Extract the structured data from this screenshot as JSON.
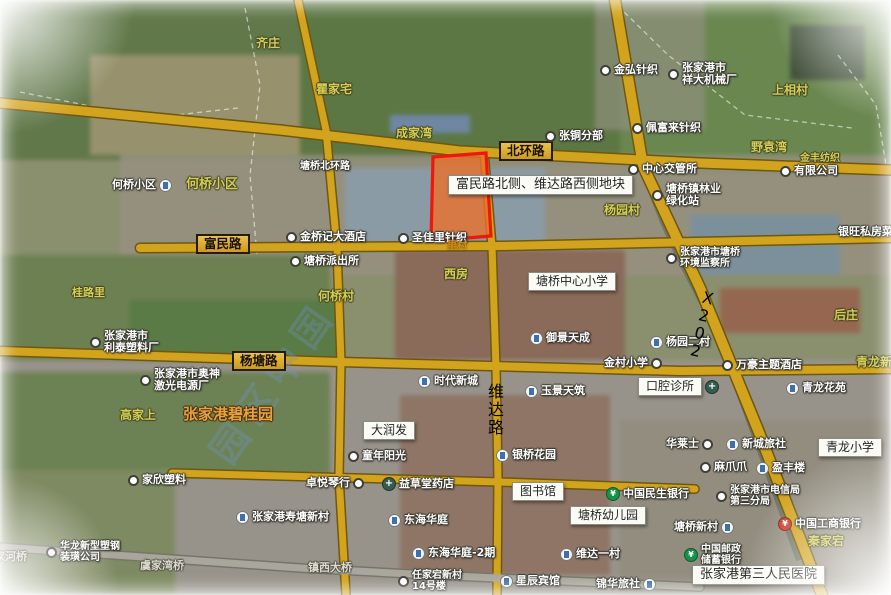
{
  "map": {
    "watermark": "园区中国",
    "colors": {
      "road_gold": "#d2a31c",
      "road_casing": "#6e570f",
      "parcel_border": "#ee1708",
      "parcel_fill": "#e8702d",
      "label_gold_box": "#ddab2b"
    },
    "parcel": {
      "label": "富民路北侧、维达路西侧地块"
    },
    "labels": [
      {
        "t": "齐庄",
        "type": "village",
        "x": 256,
        "y": 37,
        "name": "village-label-qizhuang"
      },
      {
        "t": "瞿家宅",
        "type": "village",
        "x": 316,
        "y": 83,
        "name": "village-label-qujiazhai"
      },
      {
        "t": "成家湾",
        "type": "village",
        "x": 396,
        "y": 127,
        "name": "village-label-chengjiawan"
      },
      {
        "t": "北环路",
        "type": "roadbox",
        "x": 499,
        "y": 141,
        "name": "road-label-beihuanlu"
      },
      {
        "t": "张铜分部",
        "type": "poi",
        "icon": "dot",
        "x": 545,
        "y": 130,
        "name": "poi-zhangtong-branch"
      },
      {
        "t": "金弘针织",
        "type": "poi",
        "icon": "dot",
        "x": 600,
        "y": 64,
        "name": "poi-jinhong-knitting"
      },
      {
        "t": "张家港市",
        "t2": "祥大机械厂",
        "type": "poi",
        "icon": "dot",
        "x": 668,
        "y": 62,
        "name": "poi-xiangda-machinery"
      },
      {
        "t": "上相村",
        "type": "village",
        "x": 772,
        "y": 84,
        "name": "village-label-shangxiang"
      },
      {
        "t": "佩富来针织",
        "type": "poi",
        "icon": "dot",
        "x": 632,
        "y": 122,
        "name": "poi-peifulai-knitting"
      },
      {
        "t": "野袁湾",
        "type": "village",
        "x": 751,
        "y": 141,
        "name": "village-label-yeyuanwan"
      },
      {
        "t": "金丰纺织",
        "type": "village",
        "x": 800,
        "y": 153,
        "fs": 10,
        "name": "village-label-jinfeng"
      },
      {
        "t": "有限公司",
        "type": "poi",
        "icon": "dot",
        "x": 780,
        "y": 165,
        "name": "poi-company"
      },
      {
        "t": "中心交管所",
        "type": "poi",
        "icon": "dot",
        "x": 628,
        "y": 163,
        "name": "poi-traffic-station"
      },
      {
        "t": "塘桥镇林业",
        "t2": "绿化站",
        "type": "poi",
        "icon": "dot",
        "x": 652,
        "y": 183,
        "name": "poi-forestry-station"
      },
      {
        "t": "杨园村",
        "type": "village",
        "x": 604,
        "y": 204,
        "name": "village-label-yangyuan"
      },
      {
        "t": "银旺私房菜",
        "type": "poi",
        "x": 838,
        "y": 226,
        "name": "poi-yinwang-restaurant"
      },
      {
        "t": "塘桥北环路",
        "type": "poi",
        "x": 300,
        "y": 161,
        "fs": 10,
        "name": "road-name-tangqiao-beihuanlu"
      },
      {
        "t": "何桥小区",
        "type": "poi",
        "icon": "bldg",
        "icon_pos": "after",
        "x": 112,
        "y": 179,
        "name": "poi-heqiao-estate"
      },
      {
        "t": "何桥小区",
        "type": "village",
        "x": 186,
        "y": 178,
        "fs": 13,
        "name": "village-label-heqiao-estate"
      },
      {
        "t": "富民路",
        "type": "roadbox",
        "x": 196,
        "y": 234,
        "name": "road-label-fuminlu"
      },
      {
        "t": "金桥记大酒店",
        "type": "poi",
        "icon": "dot",
        "x": 286,
        "y": 231,
        "name": "poi-hotel-jinqiaoji"
      },
      {
        "t": "圣佳里针织",
        "type": "poi",
        "icon": "dot",
        "x": 398,
        "y": 232,
        "name": "poi-shengjiali-knitting"
      },
      {
        "t": "里村",
        "type": "amber",
        "x": 447,
        "y": 241,
        "name": "village-fragment"
      },
      {
        "t": "塘桥派出所",
        "type": "poi",
        "icon": "dot",
        "x": 290,
        "y": 255,
        "name": "poi-police-station"
      },
      {
        "t": "桂路里",
        "type": "village",
        "x": 72,
        "y": 287,
        "fs": 11,
        "name": "village-label-guiluli"
      },
      {
        "t": "何桥村",
        "type": "village",
        "x": 318,
        "y": 290,
        "name": "village-label-heqiaocun"
      },
      {
        "t": "西房",
        "type": "village",
        "x": 444,
        "y": 268,
        "name": "village-label-xifang"
      },
      {
        "t": "塘桥中心小学",
        "type": "whitebox",
        "x": 528,
        "y": 272,
        "name": "poi-tangqiao-central-primary"
      },
      {
        "t": "张家港市塘桥",
        "t2": "环境监察所",
        "type": "poi",
        "icon": "dot",
        "x": 666,
        "y": 247,
        "fs": 10,
        "name": "poi-env-inspection"
      },
      {
        "t": "御景天成",
        "type": "poi",
        "icon": "bldg",
        "x": 530,
        "y": 332,
        "name": "poi-yujing-tiancheng"
      },
      {
        "t": "杨园二村",
        "type": "poi",
        "icon": "bldg",
        "x": 650,
        "y": 336,
        "name": "poi-yangyuan-ercun"
      },
      {
        "t": "X202",
        "type": "roadbox-v",
        "x": 698,
        "y": 283,
        "rot": 13,
        "name": "road-label-x202"
      },
      {
        "t": "后庄",
        "type": "village",
        "x": 834,
        "y": 309,
        "name": "village-label-houzhuang"
      },
      {
        "t": "万豪主题酒店",
        "type": "poi",
        "icon": "dot",
        "x": 722,
        "y": 359,
        "name": "poi-wanhao-hotel"
      },
      {
        "t": "青龙新村",
        "type": "village",
        "x": 856,
        "y": 356,
        "name": "village-label-qinglong-xincun"
      },
      {
        "t": "杨塘路",
        "type": "roadbox",
        "x": 232,
        "y": 351,
        "name": "road-label-yangtanglu"
      },
      {
        "t": "张家港市",
        "t2": "利泰塑料厂",
        "type": "poi",
        "icon": "dot",
        "x": 90,
        "y": 330,
        "name": "poi-litai-plastics"
      },
      {
        "t": "张家港市奥神",
        "t2": "激光电源厂",
        "type": "poi",
        "icon": "dot",
        "x": 140,
        "y": 368,
        "name": "poi-aoshen-laser"
      },
      {
        "t": "金村小学",
        "type": "poi",
        "icon": "dot",
        "icon_pos": "after",
        "x": 604,
        "y": 357,
        "name": "poi-jincun-primary"
      },
      {
        "t": "口腔诊所",
        "type": "whitebox",
        "icon": "cross",
        "icon_pos": "after",
        "x": 638,
        "y": 377,
        "name": "poi-dental-clinic"
      },
      {
        "t": "青龙花苑",
        "type": "poi",
        "icon": "bldg",
        "x": 786,
        "y": 382,
        "name": "poi-qinglong-huayuan"
      },
      {
        "t": "玉景天筑",
        "type": "poi",
        "icon": "bldg",
        "x": 525,
        "y": 385,
        "name": "poi-yujing-tianzhu"
      },
      {
        "t": "时代新城",
        "type": "poi",
        "icon": "bldg",
        "x": 418,
        "y": 375,
        "name": "poi-shidai-xincheng"
      },
      {
        "t": "维达路",
        "type": "roadbox-v",
        "x": 483,
        "y": 379,
        "name": "road-label-weidalu"
      },
      {
        "t": "高家上",
        "type": "village",
        "x": 120,
        "y": 409,
        "name": "village-label-gaojiashang"
      },
      {
        "t": "张家港碧桂园",
        "type": "orange",
        "x": 183,
        "y": 406,
        "name": "area-label-biguiyuan"
      },
      {
        "t": "大润发",
        "type": "whitebox",
        "x": 363,
        "y": 421,
        "name": "poi-rt-mart"
      },
      {
        "t": "童年阳光",
        "type": "poi",
        "icon": "dot",
        "x": 348,
        "y": 450,
        "name": "poi-tongnian-yangguang"
      },
      {
        "t": "银桥花园",
        "type": "poi",
        "icon": "bldg",
        "x": 496,
        "y": 449,
        "name": "poi-yinqiao-garden"
      },
      {
        "t": "华莱士",
        "type": "poi",
        "icon": "dot",
        "icon_pos": "after",
        "x": 666,
        "y": 438,
        "name": "poi-wallace"
      },
      {
        "t": "新城旅社",
        "type": "poi",
        "icon": "bldg",
        "x": 726,
        "y": 438,
        "name": "poi-xincheng-hostel"
      },
      {
        "t": "麻爪爪",
        "type": "poi",
        "icon": "dot",
        "x": 700,
        "y": 461,
        "name": "poi-mazhuazhua"
      },
      {
        "t": "盈丰楼",
        "type": "poi",
        "icon": "bldg",
        "x": 756,
        "y": 462,
        "name": "poi-yingfenglou"
      },
      {
        "t": "青龙小学",
        "type": "whitebox",
        "x": 818,
        "y": 438,
        "name": "poi-qinglong-primary"
      },
      {
        "t": "中国民生银行",
        "type": "poi",
        "icon": "green",
        "x": 606,
        "y": 487,
        "name": "poi-minsheng-bank"
      },
      {
        "t": "张家港市电信局",
        "t2": "第三分局",
        "type": "poi",
        "icon": "dot",
        "x": 716,
        "y": 485,
        "fs": 10,
        "name": "poi-telecom-bureau"
      },
      {
        "t": "卓悦琴行",
        "type": "poi",
        "icon": "dot",
        "icon_pos": "after",
        "x": 306,
        "y": 477,
        "name": "poi-zhuoyue-shop"
      },
      {
        "t": "益草堂药店",
        "type": "poi",
        "icon": "cross",
        "x": 382,
        "y": 477,
        "name": "poi-yicaotang-pharmacy"
      },
      {
        "t": "图书馆",
        "type": "whitebox",
        "x": 512,
        "y": 482,
        "name": "poi-library"
      },
      {
        "t": "家欣塑料",
        "type": "poi",
        "icon": "dot",
        "x": 128,
        "y": 474,
        "name": "poi-jiaxin-plastics"
      },
      {
        "t": "张家港寿塘新村",
        "type": "poi",
        "icon": "bldg",
        "x": 236,
        "y": 511,
        "name": "poi-shoutang-xincun"
      },
      {
        "t": "塘桥幼儿园",
        "type": "whitebox",
        "x": 570,
        "y": 506,
        "name": "poi-tangqiao-kindergarten"
      },
      {
        "t": "塘桥新村",
        "type": "poi",
        "icon": "bldg",
        "icon_pos": "after",
        "x": 674,
        "y": 521,
        "name": "poi-tangqiao-xincun"
      },
      {
        "t": "中国工商银行",
        "type": "poi",
        "icon": "red",
        "x": 778,
        "y": 517,
        "name": "poi-icbc-bank"
      },
      {
        "t": "秦家宕",
        "type": "village",
        "x": 808,
        "y": 535,
        "name": "village-label-qinjiadang"
      },
      {
        "t": "东海华庭",
        "type": "poi",
        "icon": "bldg",
        "x": 388,
        "y": 514,
        "name": "poi-donghai-huating"
      },
      {
        "t": "东海华庭-2期",
        "type": "poi",
        "icon": "bldg",
        "x": 412,
        "y": 547,
        "name": "poi-donghai-huating-2"
      },
      {
        "t": "维达一村",
        "type": "poi",
        "icon": "bldg",
        "x": 560,
        "y": 548,
        "name": "poi-weida-yicun"
      },
      {
        "t": "中国邮政",
        "t2": "储蓄银行",
        "type": "poi",
        "icon": "green",
        "x": 684,
        "y": 544,
        "fs": 10,
        "name": "poi-psbc-bank"
      },
      {
        "t": "镇西大桥",
        "type": "gray",
        "x": 308,
        "y": 562,
        "name": "bridge-label-zhenxi"
      },
      {
        "t": "任家宕新村",
        "t2": "14号楼",
        "type": "poi",
        "icon": "dot",
        "x": 398,
        "y": 570,
        "fs": 10,
        "name": "poi-renjiadang-xincun"
      },
      {
        "t": "星辰宾馆",
        "type": "poi",
        "icon": "bldg",
        "x": 500,
        "y": 575,
        "name": "poi-xingchen-hotel"
      },
      {
        "t": "锦华旅社",
        "type": "poi",
        "icon": "bldg",
        "icon_pos": "after",
        "x": 596,
        "y": 578,
        "name": "poi-jinhua-hostel"
      },
      {
        "t": "张家港第三人民医院",
        "type": "whitebox",
        "x": 692,
        "y": 565,
        "fs": 13,
        "name": "poi-third-peoples-hospital"
      },
      {
        "t": "华龙新型塑钢",
        "t2": "装璜公司",
        "type": "poi",
        "icon": "dot",
        "x": 46,
        "y": 541,
        "fs": 10,
        "name": "poi-hualong-plastics"
      },
      {
        "t": "家河桥",
        "type": "gray",
        "x": -6,
        "y": 551,
        "name": "bridge-label-jiahe"
      },
      {
        "t": "虞家湾桥",
        "type": "gray",
        "x": 140,
        "y": 560,
        "name": "bridge-label-yujiawan"
      },
      {
        "t": "富民路北侧、维达路西侧地块",
        "type": "whitebox",
        "x": 448,
        "y": 175,
        "fs": 13,
        "name": "parcel-info-label"
      }
    ]
  }
}
